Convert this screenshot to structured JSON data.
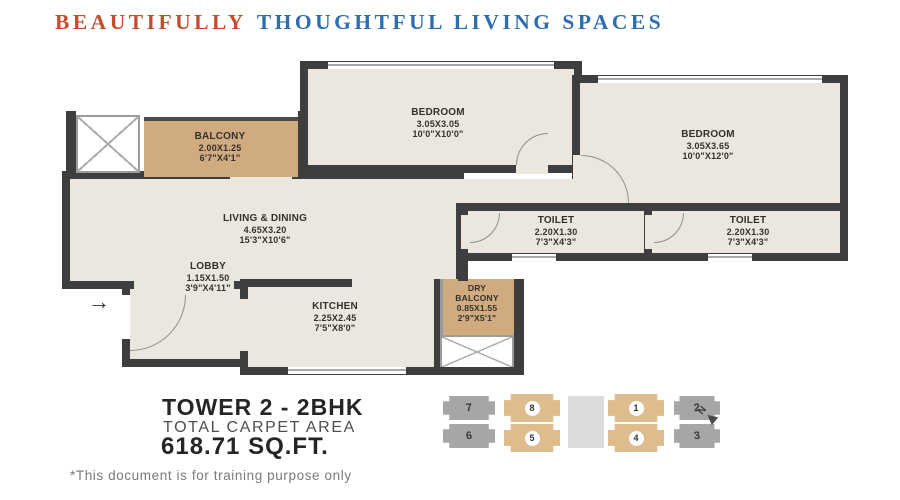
{
  "header": {
    "highlight": "BEAUTIFULLY",
    "rest": "THOUGHTFUL LIVING SPACES"
  },
  "rooms": {
    "balcony": {
      "name": "BALCONY",
      "dim_m": "2.00X1.25",
      "dim_ft": "6'7\"X4'1\""
    },
    "bedroom1": {
      "name": "BEDROOM",
      "dim_m": "3.05X3.05",
      "dim_ft": "10'0\"X10'0\""
    },
    "bedroom2": {
      "name": "BEDROOM",
      "dim_m": "3.05X3.65",
      "dim_ft": "10'0\"X12'0\""
    },
    "living": {
      "name": "LIVING & DINING",
      "dim_m": "4.65X3.20",
      "dim_ft": "15'3\"X10'6\""
    },
    "lobby": {
      "name": "LOBBY",
      "dim_m": "1.15X1.50",
      "dim_ft": "3'9\"X4'11\""
    },
    "kitchen": {
      "name": "KITCHEN",
      "dim_m": "2.25X2.45",
      "dim_ft": "7'5\"X8'0\""
    },
    "dry_balcony": {
      "name": "DRY BALCONY",
      "dim_m": "0.85X1.55",
      "dim_ft": "2'9\"X5'1\""
    },
    "toilet1": {
      "name": "TOILET",
      "dim_m": "2.20X1.30",
      "dim_ft": "7'3\"X4'3\""
    },
    "toilet2": {
      "name": "TOILET",
      "dim_m": "2.20X1.30",
      "dim_ft": "7'3\"X4'3\""
    }
  },
  "entry_arrow": "→",
  "summary": {
    "tower": "TOWER 2 - 2BHK",
    "carpet_label": "TOTAL CARPET AREA",
    "area": "618.71 SQ.FT."
  },
  "keyplan": {
    "row1": [
      {
        "no": "7",
        "highlighted": false
      },
      {
        "no": "8",
        "highlighted": true
      },
      {
        "no": "1",
        "highlighted": true
      },
      {
        "no": "2",
        "highlighted": false
      }
    ],
    "row2": [
      {
        "no": "6",
        "highlighted": false
      },
      {
        "no": "5",
        "highlighted": true
      },
      {
        "no": "4",
        "highlighted": true
      },
      {
        "no": "3",
        "highlighted": false
      }
    ],
    "north_label": "N"
  },
  "footer": "*This document is for training purpose only",
  "colors": {
    "accent_red": "#c44d2e",
    "accent_blue": "#2e6eae",
    "wall": "#3f3e3e",
    "floor": "#ece7de",
    "balcony_tan": "#cfab7f",
    "keyplan_highlight": "#debc8d",
    "keyplan_gray": "#a6a6a8"
  }
}
